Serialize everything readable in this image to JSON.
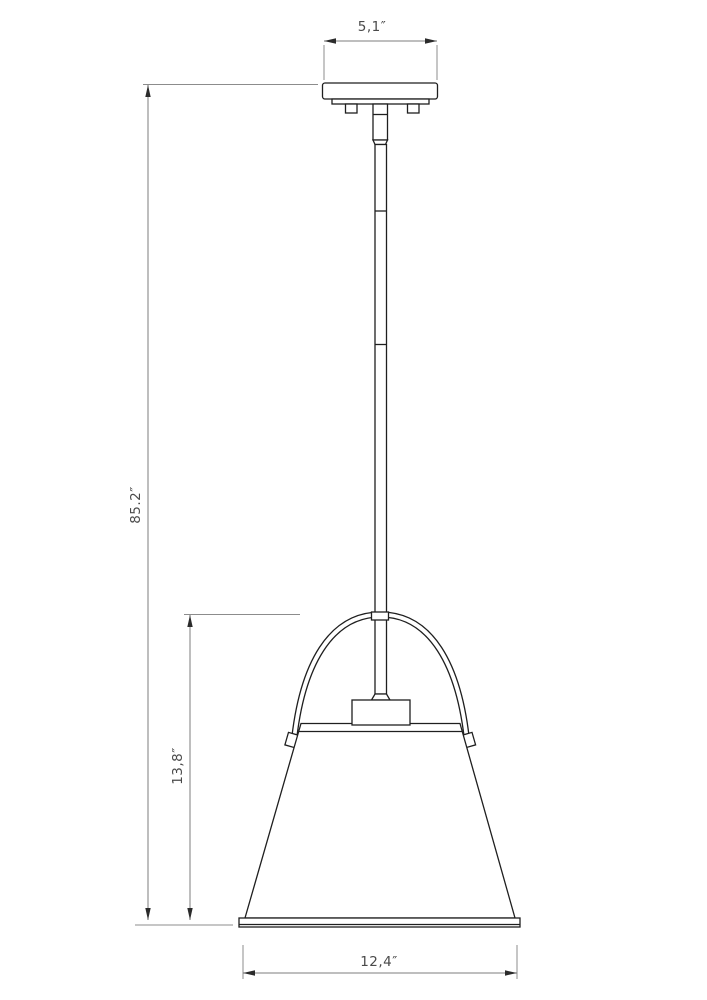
{
  "drawing": {
    "type": "technical-dimension-drawing",
    "subject": "pendant light fixture front elevation",
    "colors": {
      "background": "#ffffff",
      "object_line": "#1f1f1f",
      "dimension_line": "#7d7d7d",
      "extension_line": "#8c8c8c",
      "arrowhead": "#2b2b2b",
      "label_text": "#4a4a4a"
    },
    "dimensions": {
      "canopy_width": "5,1″",
      "overall_height": "85.2″",
      "shade_height": "13,8″",
      "shade_width": "12,4″"
    }
  }
}
